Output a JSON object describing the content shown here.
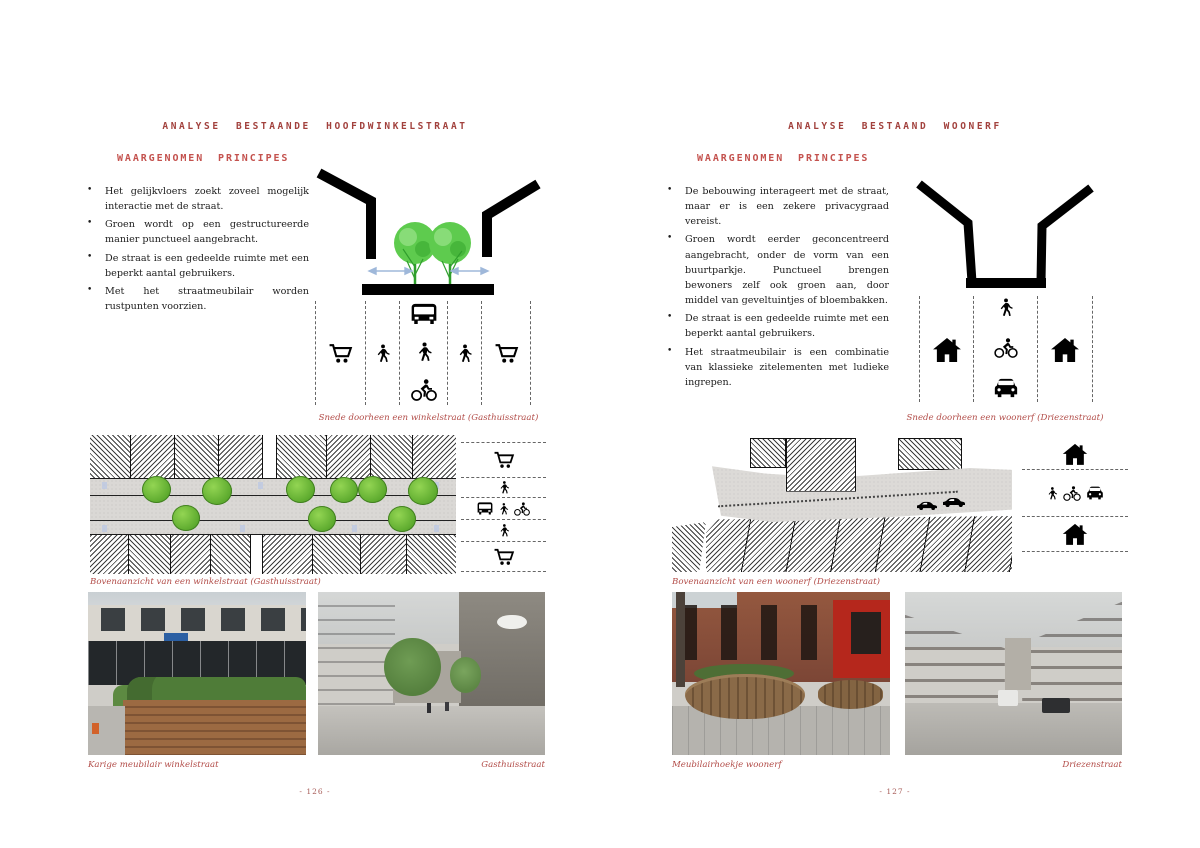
{
  "colors": {
    "title_red": "#a2413d",
    "heading_red": "#c4524e",
    "caption_red": "#b24c48",
    "tree_green": "#5ecb4e",
    "arrow_blue": "#9fb8da",
    "body_text": "#1c1c1c"
  },
  "left_page": {
    "title": "ANALYSE BESTAANDE HOOFDWINKELSTRAAT",
    "principles_heading": "WAARGENOMEN PRINCIPES",
    "bullets": [
      "Het gelijkvloers zoekt zoveel mogelijk interactie met de straat.",
      "Groen wordt op een gestructureerde manier punctueel aangebracht.",
      "De straat is een gedeelde ruimte met een beperkt aantal gebruikers.",
      "Met het straatmeubilair worden rustpunten voorzien."
    ],
    "section_diagram": {
      "caption": "Snede doorheen een winkelstraat (Gasthuisstraat)",
      "elements": [
        "building-walls",
        "street-trees",
        "interaction-arrows",
        "ground-slab"
      ],
      "lanes": [
        [
          "cart"
        ],
        [
          "pedestrian"
        ],
        [
          "bus",
          "pedestrian",
          "cyclist"
        ],
        [
          "pedestrian"
        ],
        [
          "cart"
        ]
      ]
    },
    "plan_diagram": {
      "caption": "Bovenaanzicht van een winkelstraat (Gasthuisstraat)",
      "legend_rows": [
        [
          "cart"
        ],
        [
          "pedestrian"
        ],
        [
          "bus",
          "pedestrian",
          "cyclist"
        ],
        [
          "pedestrian"
        ],
        [
          "cart"
        ]
      ]
    },
    "photo_captions": [
      "Karige meubilair winkelstraat",
      "Gasthuisstraat"
    ],
    "page_number": "- 126 -"
  },
  "right_page": {
    "title": "ANALYSE BESTAAND WOONERF",
    "principles_heading": "WAARGENOMEN PRINCIPES",
    "bullets": [
      "De bebouwing interageert met de straat, maar er is een zekere privacygraad vereist.",
      "Groen wordt eerder geconcentreerd aangebracht, onder de vorm van een buurtparkje. Punctueel brengen bewoners zelf ook groen aan, door middel van geveltuintjes of bloembakken.",
      "De straat is een gedeelde ruimte met een beperkt aantal gebruikers.",
      "Het straatmeubilair is een combinatie van klassieke zitelementen met ludieke ingrepen."
    ],
    "section_diagram": {
      "caption": "Snede doorheen een woonerf (Driezenstraat)",
      "elements": [
        "building-walls",
        "ground-slab"
      ],
      "lanes": [
        [
          "house"
        ],
        [
          "pedestrian",
          "cyclist",
          "car"
        ],
        [
          "house"
        ]
      ]
    },
    "plan_diagram": {
      "caption": "Bovenaanzicht van een woonerf (Driezenstraat)",
      "legend_rows": [
        [
          "house"
        ],
        [
          "pedestrian",
          "cyclist",
          "car"
        ],
        [
          "house"
        ]
      ]
    },
    "photo_captions": [
      "Meubilairhoekje woonerf",
      "Driezenstraat"
    ],
    "page_number": "- 127 -"
  }
}
